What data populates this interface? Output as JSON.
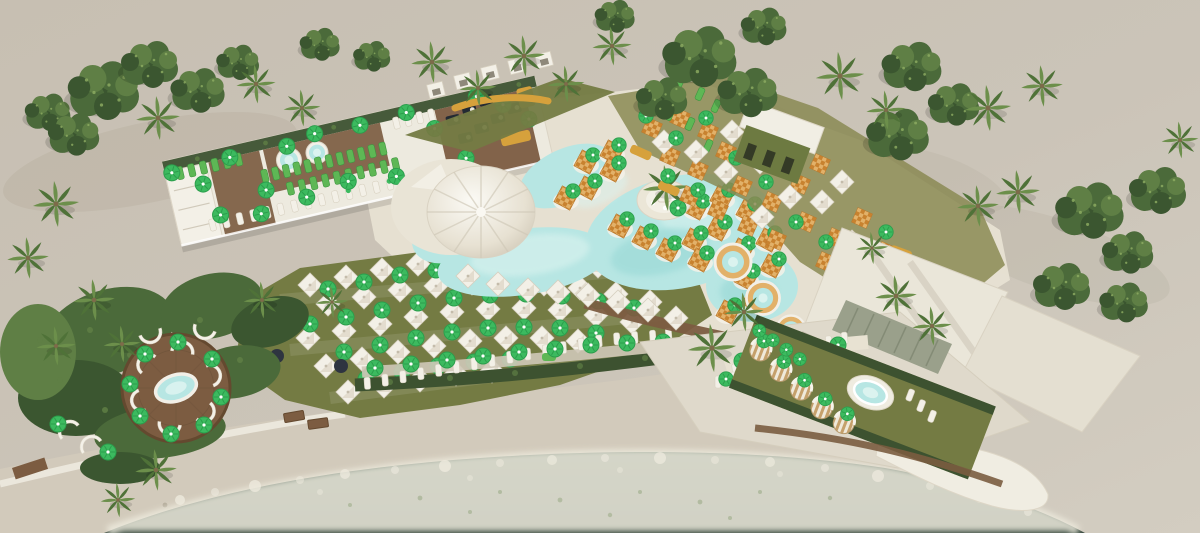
{
  "scene": {
    "title": "Beach club aerial render",
    "description": "Aerial 3D rendering of a seaside beach club: free-form turquoise pool with white canopy dome and in-water checkered daybeds, rooftop lounger terrace with plunge pools, lawns with white parasols and green umbrellas, round jacuzzi gardens with striped cabana chairs, white shade canopies, palm trees and a curving beach promenade along dark sea water with surf foam.",
    "features": [
      "free-form-pool",
      "canopy-dome",
      "pool-island",
      "in-pool-daybeds",
      "rooftop-terrace",
      "plunge-pools",
      "parasol-lawn",
      "sunbed-rows",
      "circular-wood-deck-jacuzzi",
      "dining-terrace",
      "green-roof-bar",
      "white-shade-canopies",
      "jacuzzi-garden",
      "striped-cabana-chairs",
      "palm-trees",
      "beach-promenade",
      "sea-surf"
    ]
  },
  "palette": {
    "ground": "#c9c1b5",
    "groundLight": "#d8d3c7",
    "promenade": "#d2cabb",
    "wallWhite": "#ece8dd",
    "sea": "#44584a",
    "seaDeep": "#37493e",
    "foam": "#edeadd",
    "deckCream": "#e7e1d2",
    "lawn": "#747b43",
    "hedge": "#3d5230",
    "wood": "#7c5c41",
    "woodDark": "#64492f",
    "poolWater": "#b7e6e3",
    "poolShallow": "#dbf3ef",
    "poolDeep": "#93d6d3",
    "white": "#f3f0e7",
    "umbrellaGreen": "#3cba5f",
    "umbrellaGreenDark": "#2b9e4c",
    "loungerGreen": "#5eb755",
    "orange": "#c8822f",
    "orangeLight": "#e2b169",
    "gold": "#d6a13c",
    "navy": "#232a33",
    "treeDark": "#3b5630",
    "treeMid": "#4b6a3a",
    "treeLight": "#5f7f45",
    "palmFrond": "#6c8f4b",
    "palmFrondDark": "#4f7238",
    "buildingGreen": "#6d7a41",
    "stripeTan": "#c5a06b"
  }
}
